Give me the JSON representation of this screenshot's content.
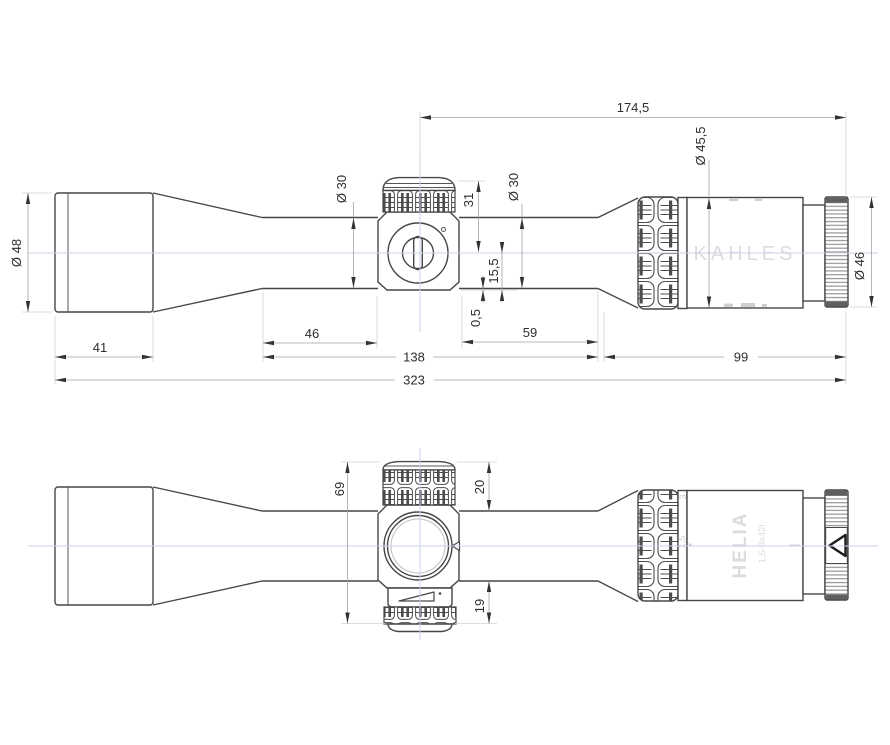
{
  "drawing_type": "riflescope-technical-drawing",
  "colors": {
    "outline": "#474747",
    "dimension_line": "#a3a3a3",
    "extension_line": "#d2d2d2",
    "centerline": "#c9d3ea",
    "arrow": "#333333",
    "engraving": "#dcdcdc",
    "dimension_text": "#2d2d2d"
  },
  "top_view": {
    "brand": "KAHLES",
    "dims": {
      "objective_diameter": "Ø 48",
      "bell_length": "41",
      "tube_diameter_front": "Ø 30",
      "turret_height": "31",
      "tube_diameter_rear": "Ø 30",
      "axis_to_saddle_bottom": "15,5",
      "saddle_protrusion": "0,5",
      "turret_center_to_rear": "174,5",
      "ocular_diameter": "Ø 45,5",
      "ring_diameter": "Ø 46",
      "tube_front_length": "46",
      "saddle_to_ocular": "59",
      "front_to_ocular": "138",
      "ocular_assembly": "99",
      "overall_length": "323"
    }
  },
  "bottom_view": {
    "model": "HELIA",
    "spec": "1,5-8x42i",
    "mag_high": "3",
    "mag_low": "1,5",
    "dims": {
      "turret_span": "69",
      "top_turret_height": "20",
      "bottom_turret_height": "19"
    }
  }
}
